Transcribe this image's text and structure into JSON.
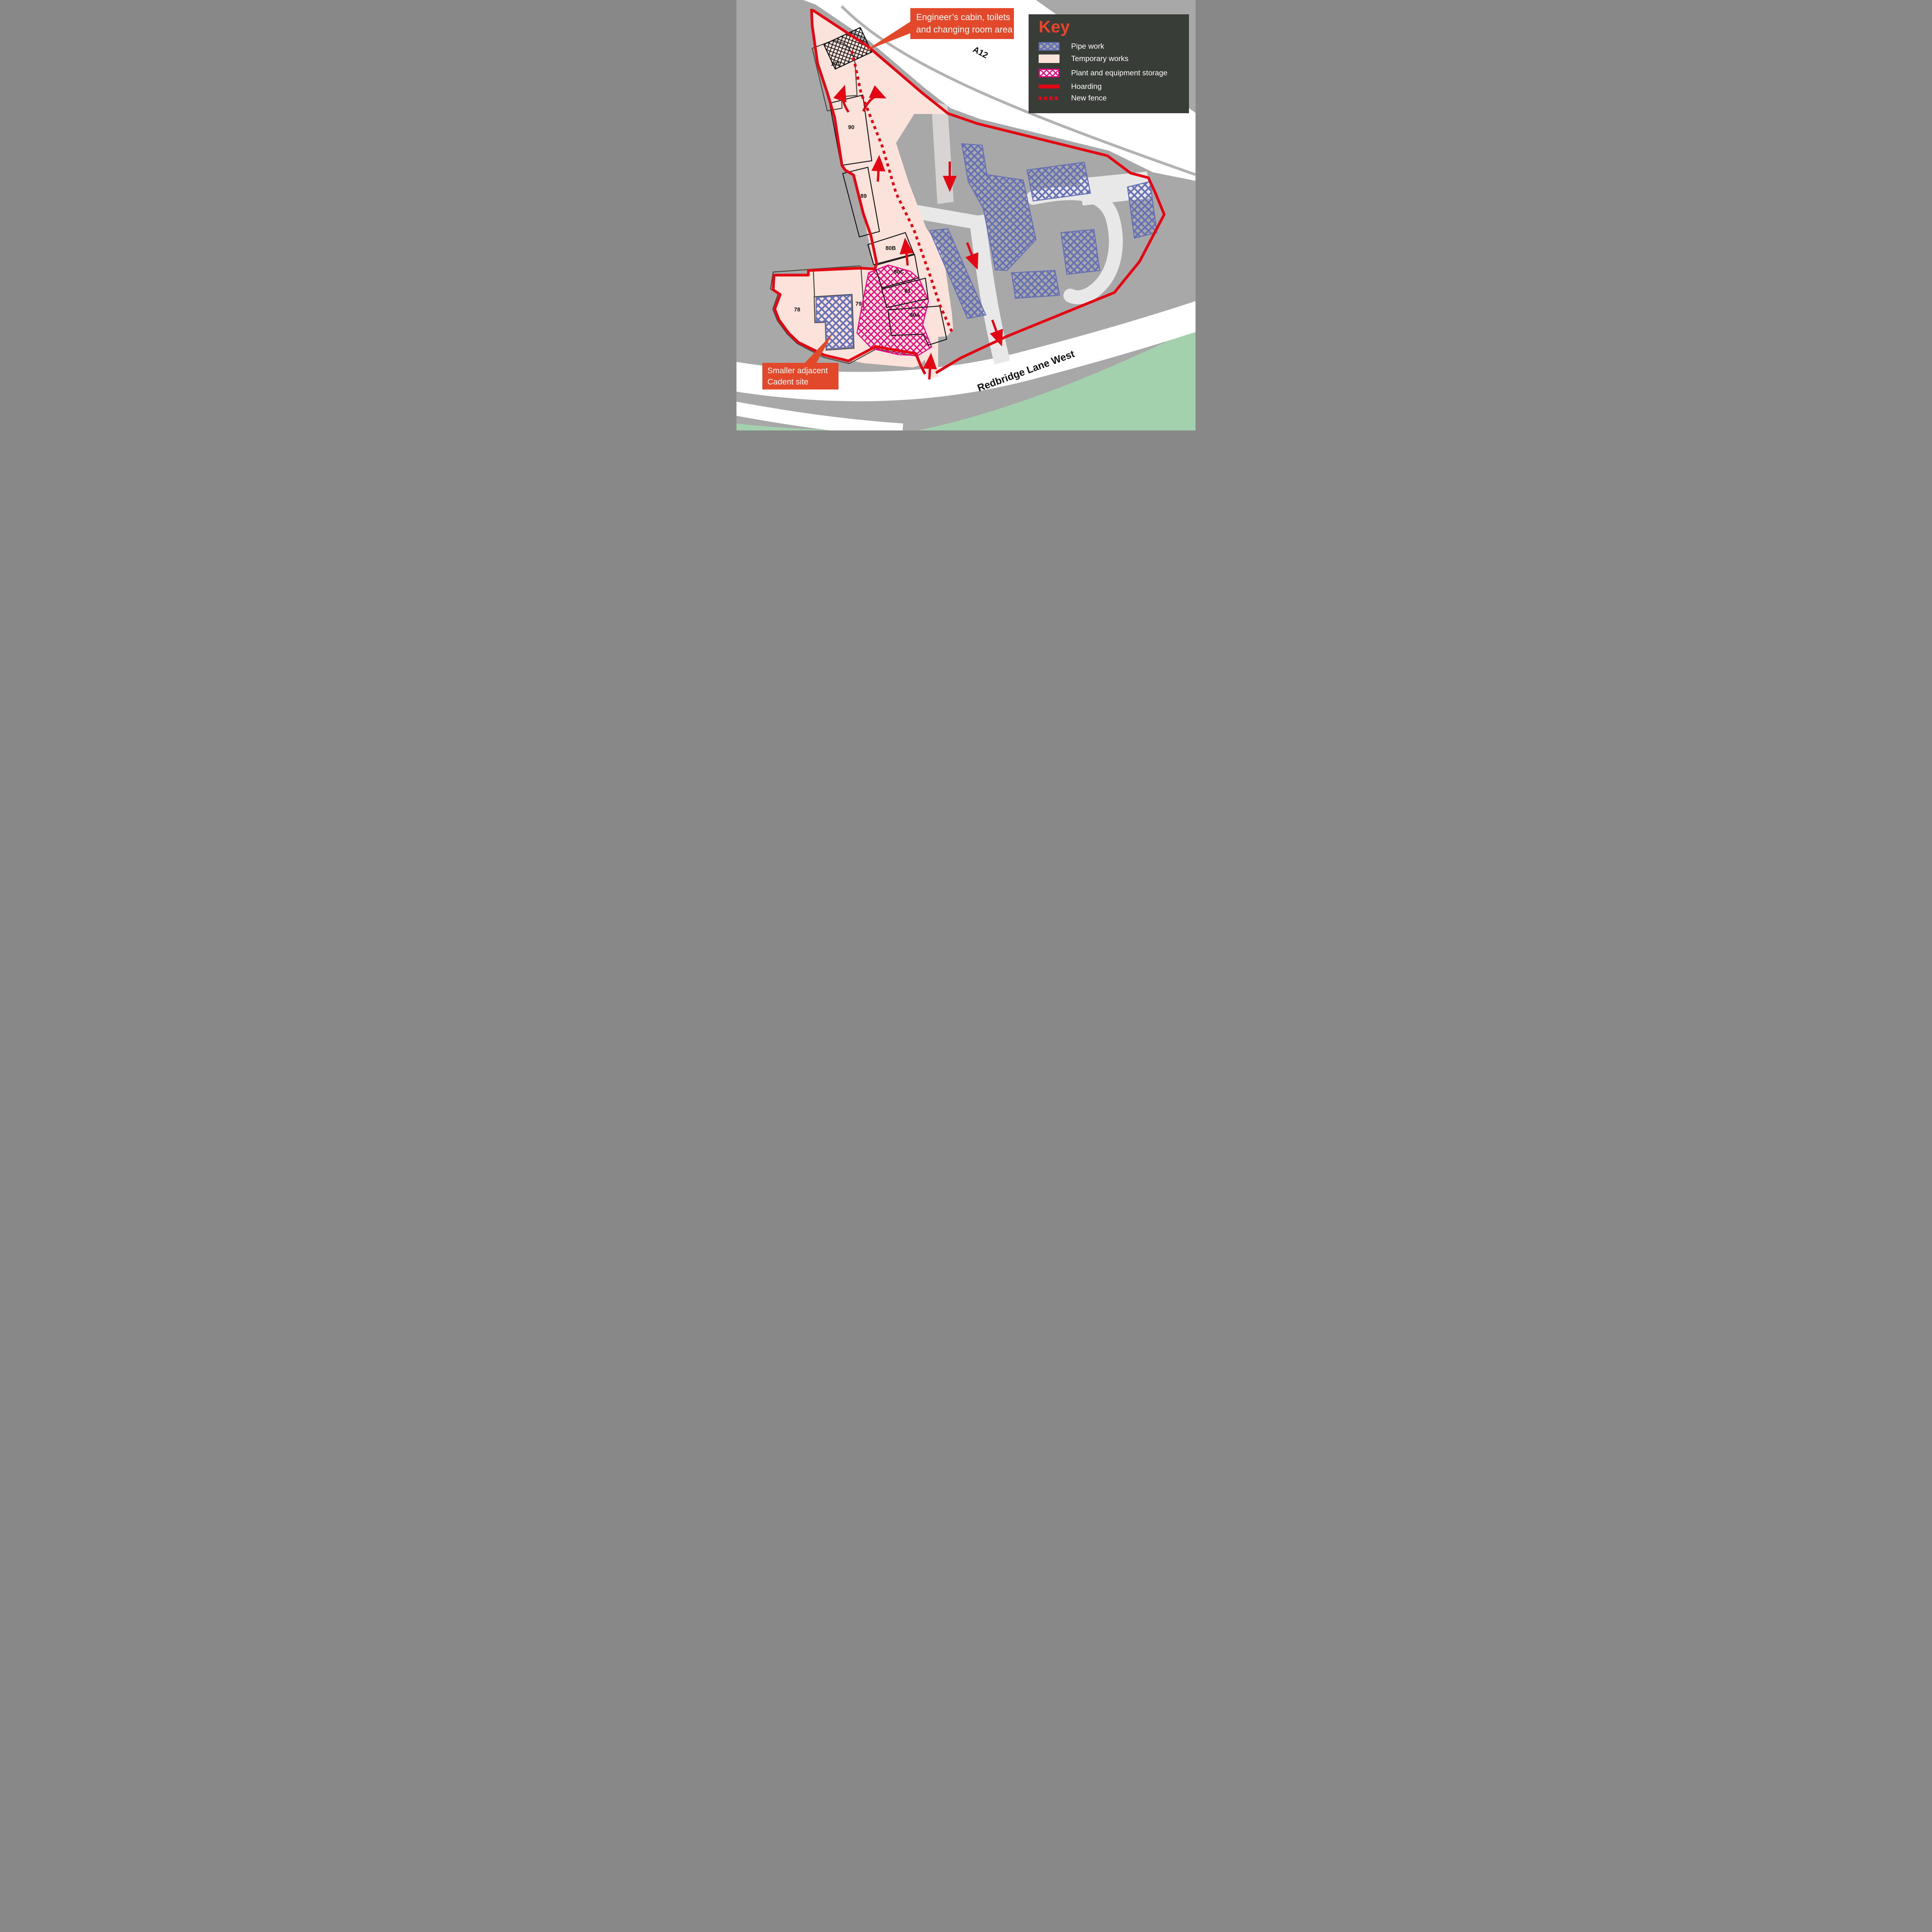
{
  "map": {
    "road_labels": {
      "a12": "A12",
      "redbridge": "Redbridge Lane West"
    },
    "building_labels": {
      "b101": "101",
      "b90": "90",
      "b89": "89",
      "b80b": "80B",
      "b80c": "80C",
      "b81": "81",
      "b80a": "80A",
      "b79": "79",
      "b78": "78"
    }
  },
  "key": {
    "title": "Key",
    "items": [
      {
        "id": "pipe-work",
        "label": "Pipe work",
        "swatch": "blue-crosshatch"
      },
      {
        "id": "temporary-works",
        "label": "Temporary works",
        "swatch": "pink-fill"
      },
      {
        "id": "plant-storage",
        "label": "Plant and equipment storage",
        "swatch": "magenta-crosshatch"
      },
      {
        "id": "hoarding",
        "label": "Hoarding",
        "swatch": "red-solid-line"
      },
      {
        "id": "new-fence",
        "label": "New fence",
        "swatch": "red-dotted-line"
      }
    ]
  },
  "callouts": {
    "engineer": {
      "line1": "Engineer’s cabin, toilets",
      "line2": "and changing room area"
    },
    "cadent": {
      "line1": "Smaller adjacent",
      "line2": "Cadent site"
    }
  },
  "colors": {
    "background_gray": "#a9a8a8",
    "hoarding_red": "#e30613",
    "pipe_blue": "#6670b4",
    "plant_magenta": "#e5007d",
    "temporary_pink": "#fbe2db",
    "callout_orange": "#e2492a",
    "key_panel_bg": "#383d37",
    "grass_green": "#a3d1ad"
  }
}
